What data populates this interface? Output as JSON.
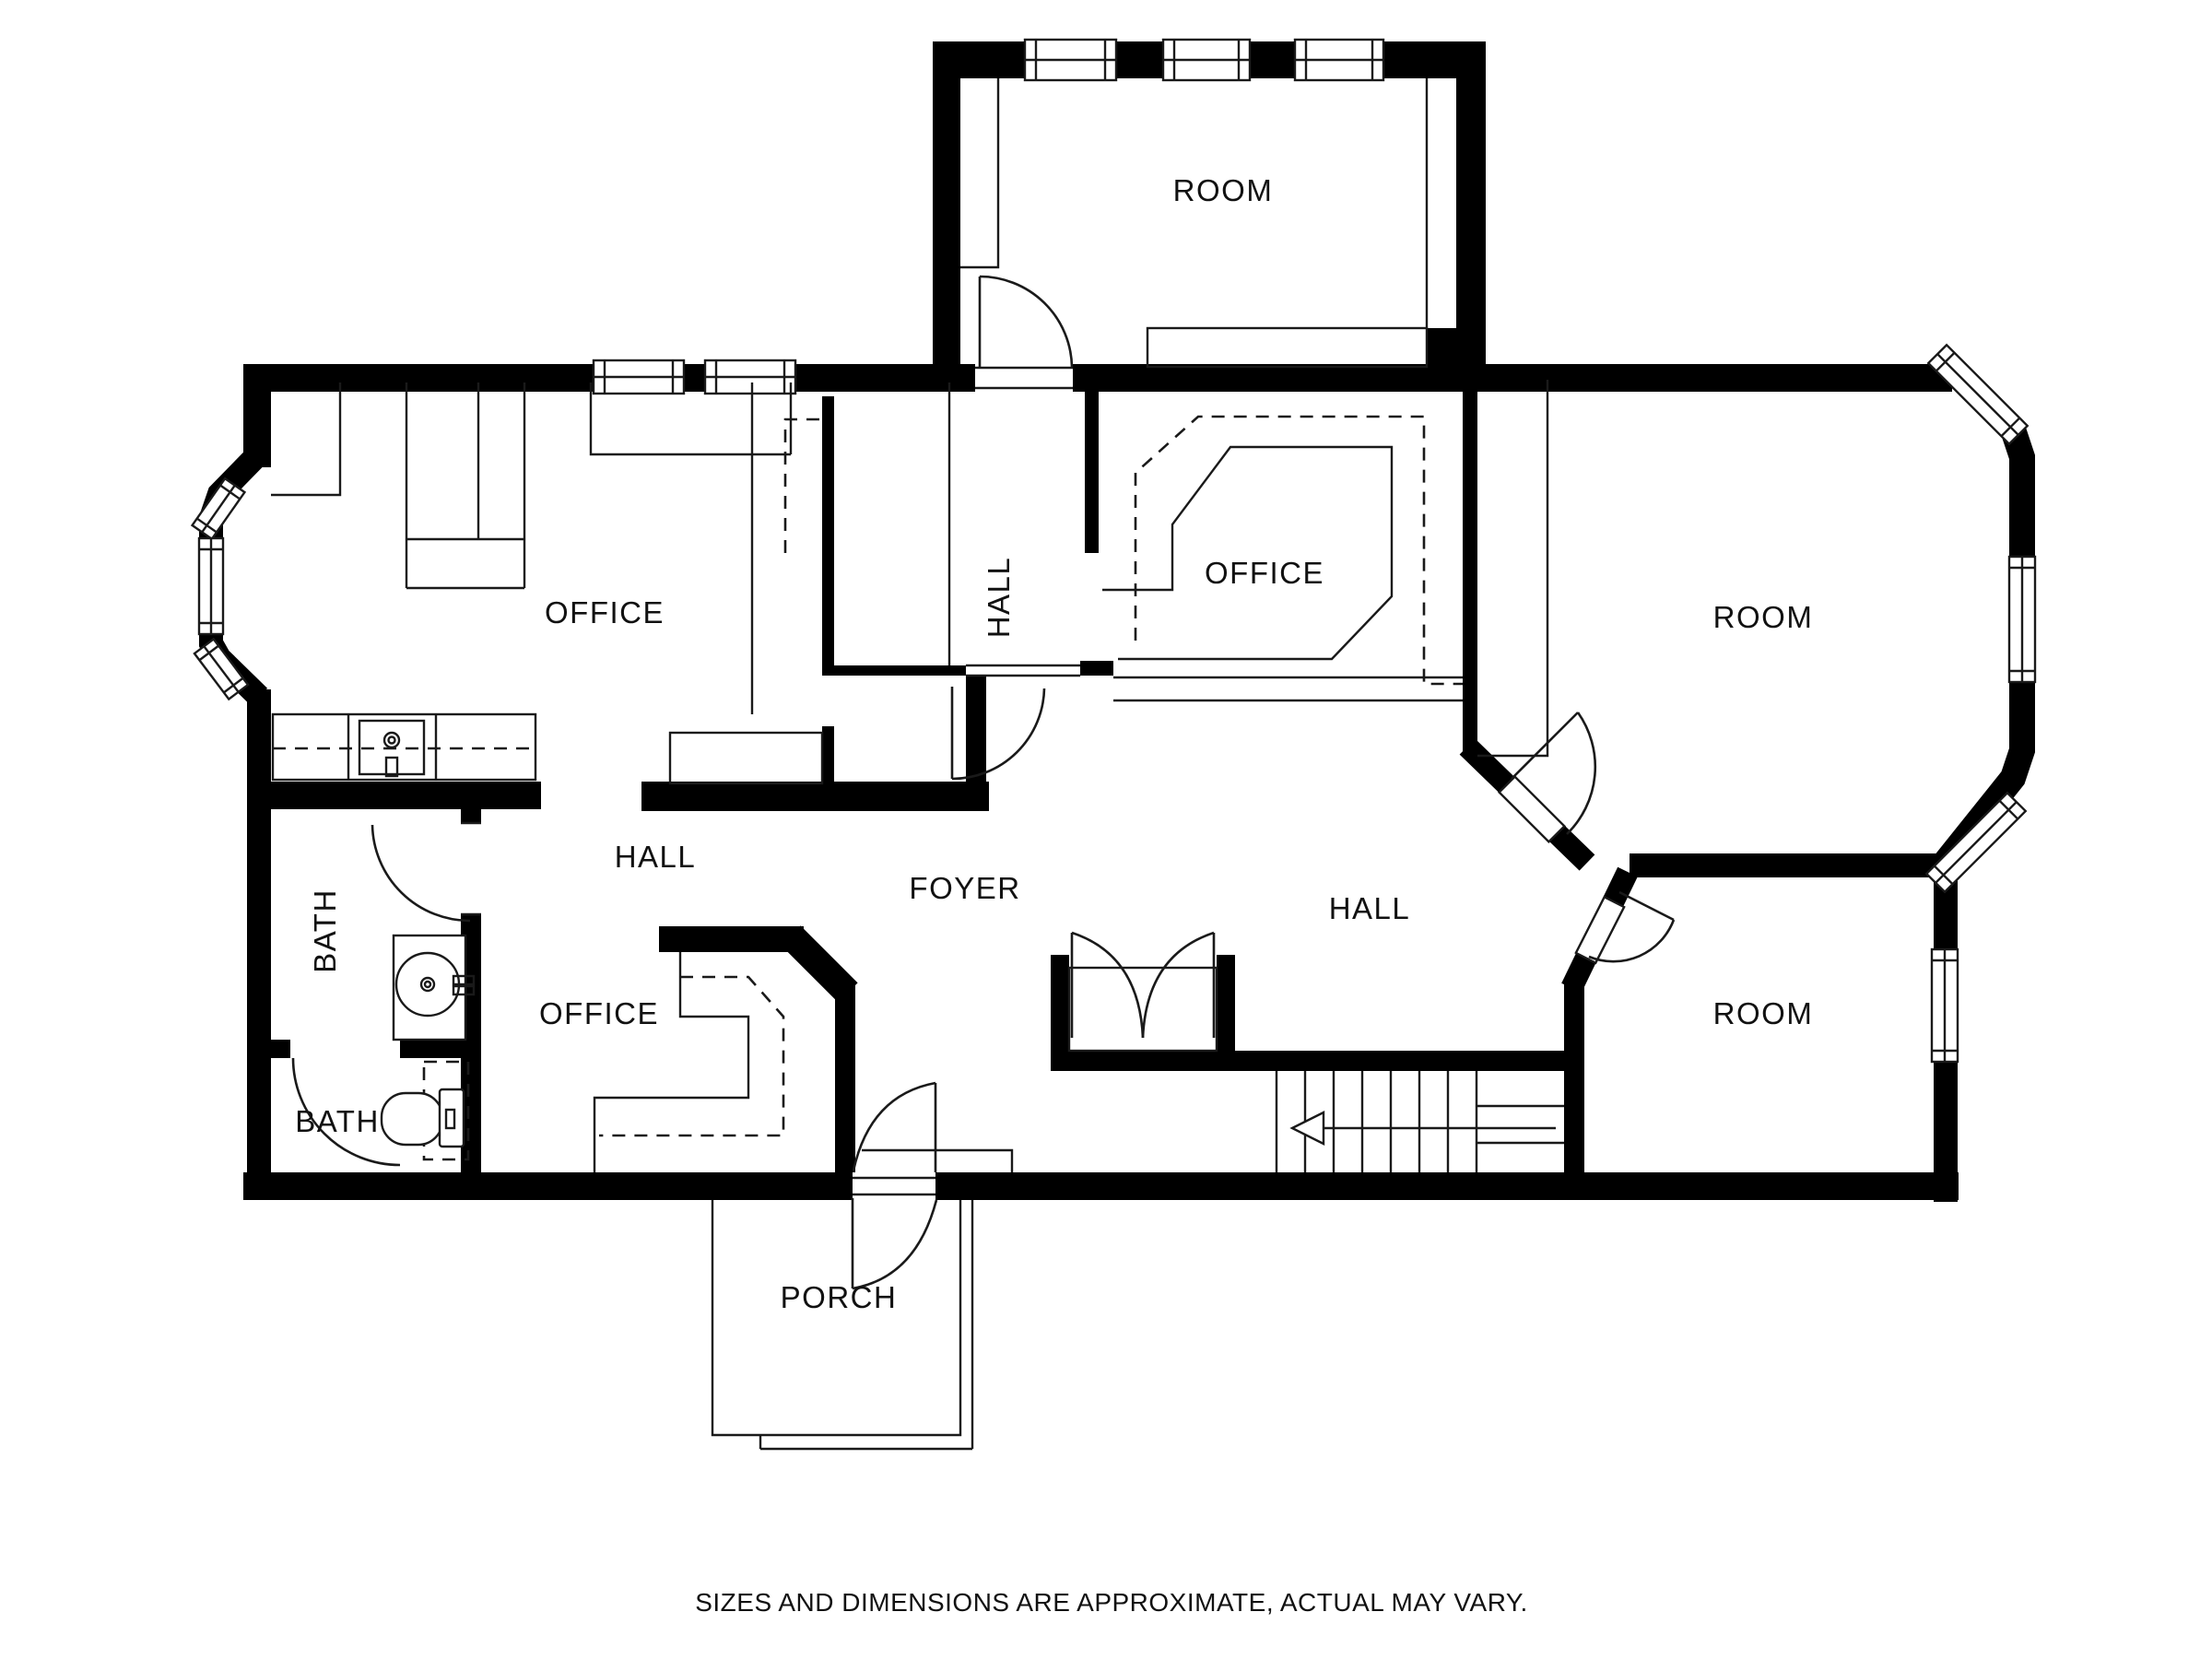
{
  "plan": {
    "type": "floorplan",
    "background": "#ffffff",
    "wall_color": "#000000",
    "line_color": "#1a1a1a",
    "labels": [
      {
        "id": "room-top",
        "text": "ROOM"
      },
      {
        "id": "office-left",
        "text": "OFFICE"
      },
      {
        "id": "hall-corridor",
        "text": "HALL"
      },
      {
        "id": "office-center",
        "text": "OFFICE"
      },
      {
        "id": "room-right",
        "text": "ROOM"
      },
      {
        "id": "hall-left",
        "text": "HALL"
      },
      {
        "id": "foyer",
        "text": "FOYER"
      },
      {
        "id": "hall-right",
        "text": "HALL"
      },
      {
        "id": "bath-upper",
        "text": "BATH"
      },
      {
        "id": "office-lower",
        "text": "OFFICE"
      },
      {
        "id": "bath-lower",
        "text": "BATH"
      },
      {
        "id": "room-bottom-right",
        "text": "ROOM"
      },
      {
        "id": "porch",
        "text": "PORCH"
      }
    ],
    "caption": "SIZES AND DIMENSIONS ARE APPROXIMATE, ACTUAL MAY VARY."
  }
}
